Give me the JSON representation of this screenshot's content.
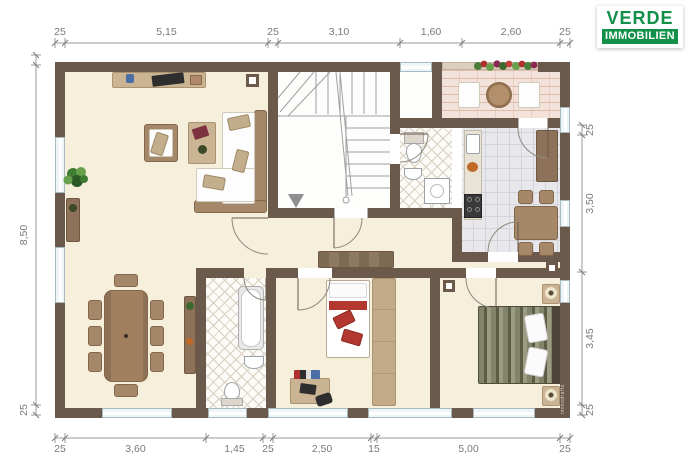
{
  "logo": {
    "title": "VERDE",
    "subtitle": "IMMOBILIEN"
  },
  "watermark": "immodrafts",
  "colors": {
    "green": "#12904a",
    "wall": "#6b5a4b",
    "floor": "#f5efdc",
    "red": "#b23830",
    "glass": "#eef5f7",
    "dim": "#8a8a8a"
  },
  "dimensions": {
    "top": {
      "orientation": "h",
      "pos": 43,
      "labelOffset": -8,
      "segments": [
        {
          "label": "25",
          "from": 55,
          "to": 65
        },
        {
          "label": "5,15",
          "from": 65,
          "to": 268
        },
        {
          "label": "25",
          "from": 268,
          "to": 278
        },
        {
          "label": "3,10",
          "from": 278,
          "to": 400
        },
        {
          "label": "1,60",
          "from": 400,
          "to": 462
        },
        {
          "label": "2,60",
          "from": 462,
          "to": 560
        },
        {
          "label": "25",
          "from": 560,
          "to": 570
        }
      ]
    },
    "bottom": {
      "orientation": "h",
      "pos": 438,
      "labelOffset": 14,
      "segments": [
        {
          "label": "25",
          "from": 55,
          "to": 65
        },
        {
          "label": "3,60",
          "from": 65,
          "to": 206
        },
        {
          "label": "1,45",
          "from": 206,
          "to": 263
        },
        {
          "label": "25",
          "from": 263,
          "to": 273
        },
        {
          "label": "2,50",
          "from": 273,
          "to": 371
        },
        {
          "label": "15",
          "from": 371,
          "to": 377
        },
        {
          "label": "5,00",
          "from": 377,
          "to": 560
        },
        {
          "label": "25",
          "from": 560,
          "to": 570
        }
      ]
    },
    "left": {
      "orientation": "v",
      "pos": 36,
      "labelOffset": -9,
      "segments": [
        {
          "label": "",
          "from": 55,
          "to": 65
        },
        {
          "label": "8,50",
          "from": 65,
          "to": 405
        },
        {
          "label": "25",
          "from": 405,
          "to": 415
        }
      ]
    },
    "right": {
      "orientation": "v",
      "pos": 582,
      "labelOffset": 11,
      "segments": [
        {
          "label": "25",
          "from": 125,
          "to": 135
        },
        {
          "label": "3,50",
          "from": 135,
          "to": 272
        },
        {
          "label": "3,45",
          "from": 272,
          "to": 405
        },
        {
          "label": "25",
          "from": 405,
          "to": 415
        }
      ]
    }
  }
}
